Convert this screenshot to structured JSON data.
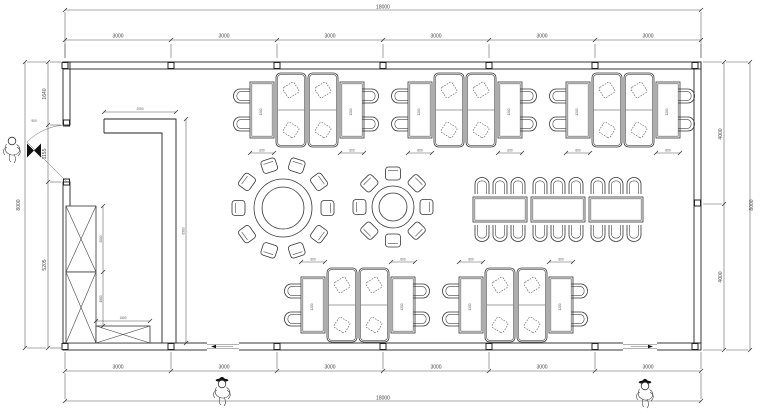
{
  "dims": {
    "top_overall": "18000",
    "bottom_overall": "18000",
    "segment": "3000",
    "left_overall": "8000",
    "left_segments": [
      "1640",
      "1155",
      "5205"
    ],
    "right_overall": "8000",
    "right_segments": [
      "4000",
      "4000"
    ],
    "door_width": "900",
    "partition_width": "2000",
    "partition_height": "6300",
    "cabinet_upper": "2000",
    "cabinet_lower": "1800",
    "cabinet_low_width": "1500",
    "table_width": "600",
    "table_length": "1200"
  },
  "furniture": {
    "booth_groups_top": 3,
    "booth_groups_bottom": 2,
    "round_table_large_seats": 10,
    "round_table_small_seats": 8,
    "banquet_sections": 3,
    "banquet_seats": 18,
    "figures": 3
  },
  "colors": {
    "line": "#333333",
    "dim": "#555555",
    "background": "#ffffff"
  }
}
